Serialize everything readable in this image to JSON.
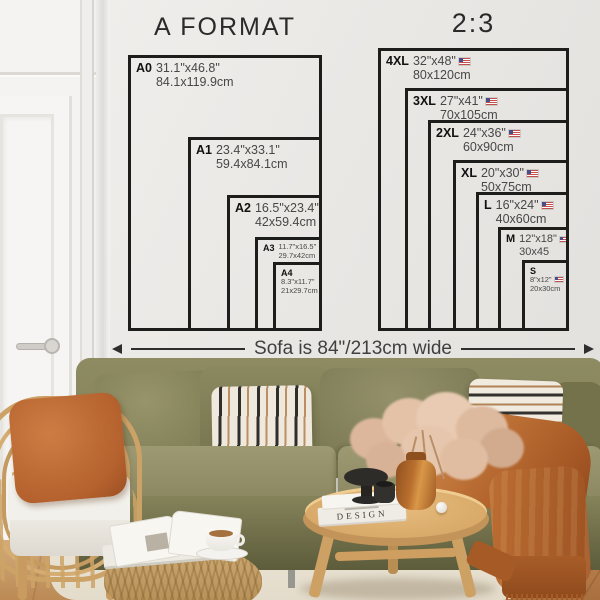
{
  "charts": {
    "a_format": {
      "title": "A FORMAT",
      "sizes": [
        {
          "code": "A0",
          "inches": "31.1\"x46.8\"",
          "cm": "84.1x119.9cm"
        },
        {
          "code": "A1",
          "inches": "23.4\"x33.1\"",
          "cm": "59.4x84.1cm"
        },
        {
          "code": "A2",
          "inches": "16.5\"x23.4\"",
          "cm": "42x59.4cm"
        },
        {
          "code": "A3",
          "inches": "11.7\"x16.5\"",
          "cm": "29.7x42cm"
        },
        {
          "code": "A4",
          "inches": "8.3\"x11.7\"",
          "cm": "21x29.7cm"
        }
      ]
    },
    "ratio_2_3": {
      "title": "2:3",
      "sizes": [
        {
          "code": "4XL",
          "inches": "32\"x48\"",
          "cm": "80x120cm",
          "flag_icon": "us-flag-icon"
        },
        {
          "code": "3XL",
          "inches": "27\"x41\"",
          "cm": "70x105cm",
          "flag_icon": "us-flag-icon"
        },
        {
          "code": "2XL",
          "inches": "24\"x36\"",
          "cm": "60x90cm",
          "flag_icon": "us-flag-icon"
        },
        {
          "code": "XL",
          "inches": "20\"x30\"",
          "cm": "50x75cm",
          "flag_icon": "us-flag-icon"
        },
        {
          "code": "L",
          "inches": "16\"x24\"",
          "cm": "40x60cm",
          "flag_icon": "us-flag-icon"
        },
        {
          "code": "M",
          "inches": "12\"x18\"",
          "cm": "30x45",
          "flag_icon": "us-flag-icon"
        },
        {
          "code": "S",
          "inches": "8\"x12\"",
          "cm": "20x30cm",
          "flag_icon": "us-flag-icon"
        }
      ]
    }
  },
  "caption": {
    "sofa_width": "Sofa is 84\"/213cm wide"
  },
  "decor": {
    "book_spine": "DESIGN"
  },
  "colors": {
    "frame_line": "#1d1d1b",
    "wall": "#eae8e5",
    "sofa_olive": "#8a8760",
    "throw_rust": "#b4662c",
    "pillow_orange": "#bf6f38",
    "wood": "#dcae6f"
  }
}
